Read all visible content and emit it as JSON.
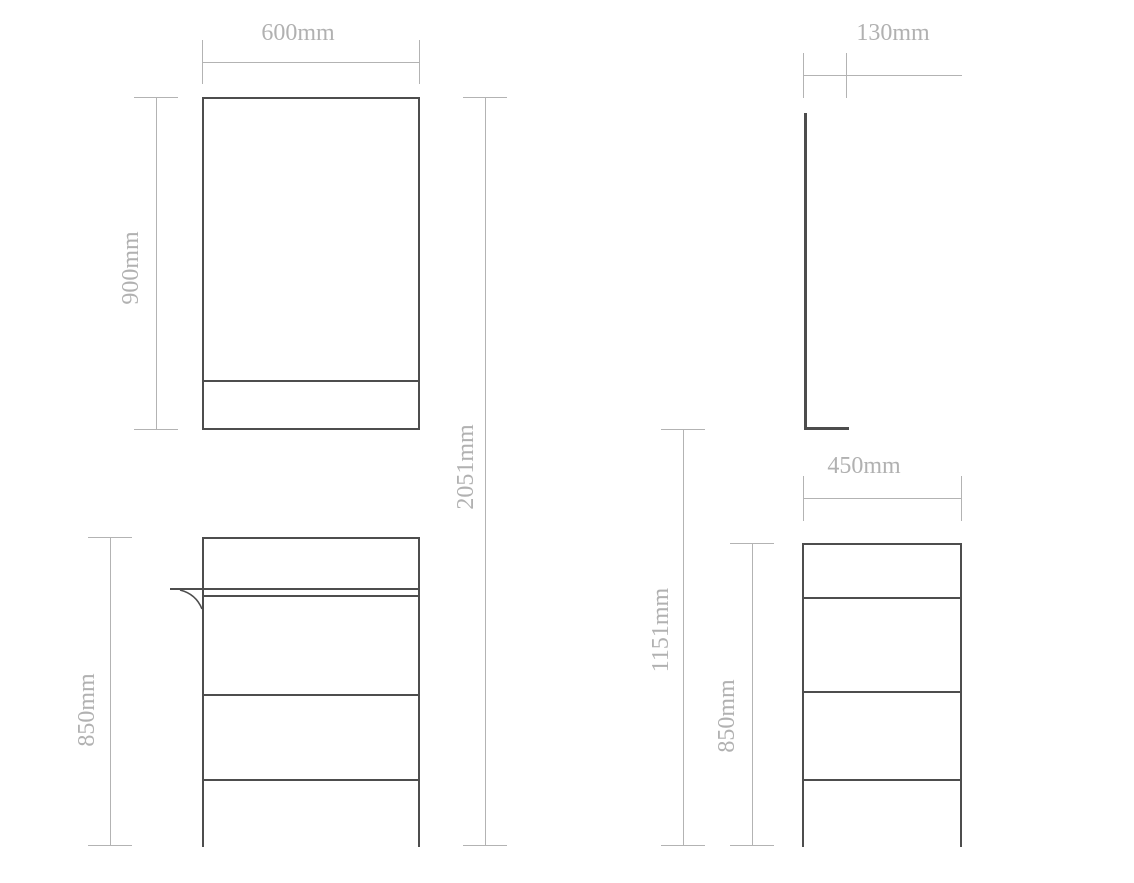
{
  "front_view": {
    "labels": {
      "mirror_width": "600mm",
      "mirror_height": "900mm",
      "overall_height": "2051mm",
      "cabinet_height": "850mm"
    }
  },
  "side_view": {
    "labels": {
      "mirror_depth": "130mm",
      "cabinet_depth": "450mm",
      "mirror_bottom_to_floor": "1151mm",
      "cabinet_height": "850mm"
    }
  },
  "colors": {
    "object_line": "#4d4d4d",
    "dimension_line": "#b3b3b3",
    "label_text": "#b1b1b1",
    "background": "#ffffff"
  }
}
